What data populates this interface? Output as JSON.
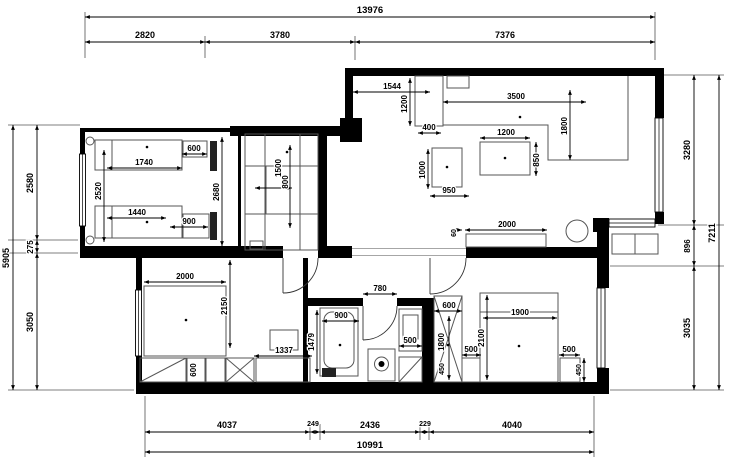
{
  "drawing": {
    "type": "apartment floor plan",
    "units": "mm"
  },
  "dims": {
    "top": {
      "total": "13976",
      "segs": [
        "2820",
        "3780",
        "7376"
      ]
    },
    "left": {
      "total": "5905",
      "segs": [
        "2580",
        "275",
        "3050"
      ]
    },
    "right": {
      "total": "7211",
      "segs": [
        "3280",
        "896",
        "3035"
      ]
    },
    "bottom": {
      "total": "10991",
      "segs": [
        "4037",
        "249",
        "2436",
        "229",
        "4040"
      ]
    },
    "kid_room": {
      "bed1": "1740",
      "desk": "600",
      "width": "2520",
      "bed2": "1440",
      "desk2": "900",
      "length": "2680"
    },
    "closet": {
      "turning_circle": "1500",
      "depth": "800"
    },
    "kitchen": {
      "entry": "1544",
      "fridge_depth": "1200",
      "fridge_width": "400",
      "counter_len": "3500",
      "counter_leg": "1800",
      "table_width": "1200",
      "table_depth": "850",
      "unit_len": "1000",
      "unit_width": "950",
      "sideboard": "2000",
      "gap": "60"
    },
    "bathroom": {
      "door": "780",
      "tub_width": "900",
      "tub_length": "1479",
      "basin": "500"
    },
    "bedroom_left": {
      "bed_width": "2000",
      "bed_length": "2150",
      "wardrobe": "600",
      "dresser": "1337"
    },
    "bedroom_right": {
      "wardrobe_width": "600",
      "wardrobe_length": "1800",
      "wardrobe_side": "450",
      "nightstand_left": "500",
      "bed_length": "2100",
      "bed_width": "1900",
      "nightstand_right": "500",
      "nightstand_depth": "450"
    }
  }
}
